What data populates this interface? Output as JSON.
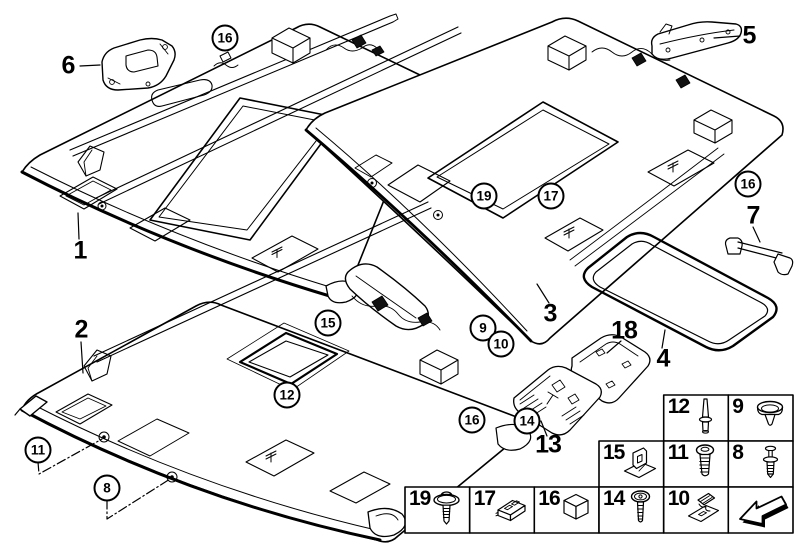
{
  "figure": {
    "background_color": "#ffffff",
    "line_color": "#000000",
    "description": "Exploded parts diagram of three car headliner panels with trim parts, sunroof seal and fastener legend"
  },
  "callouts": [
    {
      "label": "6",
      "type": "plain"
    },
    {
      "label": "16",
      "type": "circled"
    },
    {
      "label": "5",
      "type": "plain"
    },
    {
      "label": "1",
      "type": "plain"
    },
    {
      "label": "19",
      "type": "circled"
    },
    {
      "label": "17",
      "type": "circled"
    },
    {
      "label": "16",
      "type": "circled"
    },
    {
      "label": "7",
      "type": "plain"
    },
    {
      "label": "2",
      "type": "plain"
    },
    {
      "label": "3",
      "type": "plain"
    },
    {
      "label": "18",
      "type": "plain"
    },
    {
      "label": "4",
      "type": "plain"
    },
    {
      "label": "15",
      "type": "circled"
    },
    {
      "label": "9",
      "type": "circled"
    },
    {
      "label": "10",
      "type": "circled"
    },
    {
      "label": "12",
      "type": "circled"
    },
    {
      "label": "16",
      "type": "circled"
    },
    {
      "label": "14",
      "type": "circled"
    },
    {
      "label": "13",
      "type": "plain"
    },
    {
      "label": "11",
      "type": "circled"
    },
    {
      "label": "8",
      "type": "circled"
    }
  ],
  "legend": {
    "cells": [
      {
        "number": "12",
        "icon": "push-pin"
      },
      {
        "number": "9",
        "icon": "grommet-clip"
      },
      {
        "number": "15",
        "icon": "bracket-clip"
      },
      {
        "number": "11",
        "icon": "pan-head-screw"
      },
      {
        "number": "8",
        "icon": "expansion-rivet"
      },
      {
        "number": "19",
        "icon": "screw-with-washer"
      },
      {
        "number": "17",
        "icon": "slide-clip"
      },
      {
        "number": "16",
        "icon": "spacer-block"
      },
      {
        "number": "14",
        "icon": "torx-screw"
      },
      {
        "number": "10",
        "icon": "clip-with-plate"
      },
      {
        "number": "",
        "icon": "back-arrow"
      }
    ]
  }
}
